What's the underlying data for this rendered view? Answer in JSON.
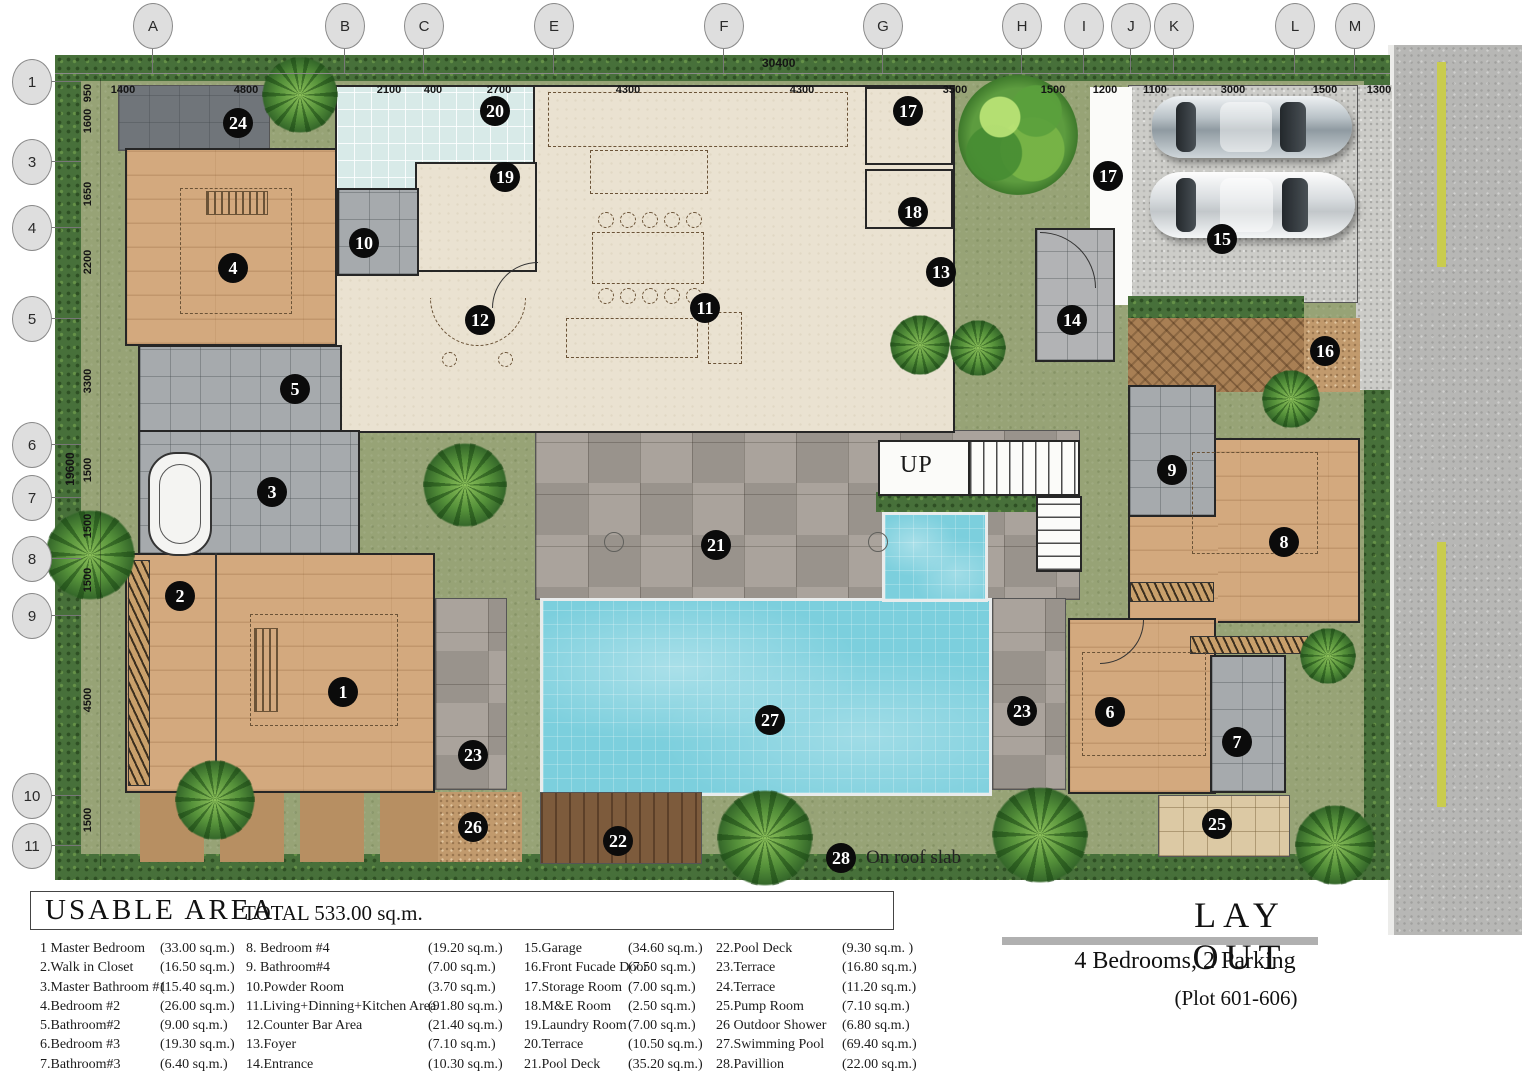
{
  "header": {
    "up_label": "UP",
    "roof_label": "On roof slab",
    "overall_width": "30400",
    "overall_height": "19600"
  },
  "legend": {
    "title": "USABLE  AREA",
    "total": "TOTAL 533.00 sq.m.",
    "columns": [
      {
        "left": 40,
        "area_left": 120,
        "items": [
          [
            "1 Master Bedroom",
            "(33.00 sq.m.)"
          ],
          [
            "2.Walk in Closet",
            "(16.50 sq.m.)"
          ],
          [
            "3.Master Bathroom #1",
            "(15.40 sq.m.)"
          ],
          [
            "4.Bedroom #2",
            "(26.00 sq.m.)"
          ],
          [
            "5.Bathroom#2",
            "(9.00  sq.m.)"
          ],
          [
            "6.Bedroom #3",
            "(19.30 sq.m.)"
          ],
          [
            "7.Bathroom#3",
            "(6.40  sq.m.)"
          ]
        ]
      },
      {
        "left": 246,
        "area_left": 182,
        "items": [
          [
            "8. Bedroom #4",
            "(19.20 sq.m.)"
          ],
          [
            "9. Bathroom#4",
            "(7.00  sq.m.)"
          ],
          [
            "10.Powder  Room",
            "(3.70  sq.m.)"
          ],
          [
            "11.Living+Dinning+Kitchen Area",
            "(91.80 sq.m.)"
          ],
          [
            "12.Counter Bar Area",
            "(21.40 sq.m.)"
          ],
          [
            "13.Foyer",
            "(7.10  sq.m.)"
          ],
          [
            "14.Entrance",
            "(10.30 sq.m.)"
          ]
        ]
      },
      {
        "left": 524,
        "area_left": 104,
        "items": [
          [
            "15.Garage",
            "(34.60 sq.m.)"
          ],
          [
            "16.Front Fucade Door",
            "(7.50 sq.m.)"
          ],
          [
            "17.Storage  Room",
            "(7.00  sq.m.)"
          ],
          [
            "18.M&E Room",
            "(2.50  sq.m.)"
          ],
          [
            "19.Laundry Room",
            "(7.00  sq.m.)"
          ],
          [
            "20.Terrace",
            "(10.50 sq.m.)"
          ],
          [
            "21.Pool  Deck",
            "(35.20 sq.m.)"
          ]
        ]
      },
      {
        "left": 716,
        "area_left": 126,
        "items": [
          [
            "22.Pool Deck",
            "(9.30 sq.m. )"
          ],
          [
            "23.Terrace",
            "(16.80 sq.m.)"
          ],
          [
            "24.Terrace",
            "(11.20 sq.m.)"
          ],
          [
            "25.Pump Room",
            "(7.10  sq.m.)"
          ],
          [
            "26 Outdoor Shower",
            "(6.80  sq.m.)"
          ],
          [
            "27.Swimming Pool",
            "(69.40 sq.m.)"
          ],
          [
            "28.Pavillion",
            "(22.00 sq.m.)"
          ]
        ]
      }
    ]
  },
  "layout_panel": {
    "title": "LAY OUT",
    "subtitle": "4 Bedrooms, 2 Parking",
    "plot": "(Plot  601-606)"
  },
  "grid": {
    "top": [
      {
        "label": "A",
        "x": 152
      },
      {
        "label": "B",
        "x": 344
      },
      {
        "label": "C",
        "x": 423
      },
      {
        "label": "E",
        "x": 553
      },
      {
        "label": "F",
        "x": 723
      },
      {
        "label": "G",
        "x": 882
      },
      {
        "label": "H",
        "x": 1021
      },
      {
        "label": "I",
        "x": 1083
      },
      {
        "label": "J",
        "x": 1130
      },
      {
        "label": "K",
        "x": 1173
      },
      {
        "label": "L",
        "x": 1294
      },
      {
        "label": "M",
        "x": 1354
      }
    ],
    "left": [
      {
        "label": "1",
        "y": 81
      },
      {
        "label": "3",
        "y": 161
      },
      {
        "label": "4",
        "y": 227
      },
      {
        "label": "5",
        "y": 318
      },
      {
        "label": "6",
        "y": 444
      },
      {
        "label": "7",
        "y": 497
      },
      {
        "label": "8",
        "y": 558
      },
      {
        "label": "9",
        "y": 615
      },
      {
        "label": "10",
        "y": 795
      },
      {
        "label": "11",
        "y": 845
      }
    ]
  },
  "dims": {
    "top": [
      {
        "t": "1400",
        "x": 123
      },
      {
        "t": "4800",
        "x": 246
      },
      {
        "t": "2100",
        "x": 389
      },
      {
        "t": "400",
        "x": 433
      },
      {
        "t": "2700",
        "x": 499
      },
      {
        "t": "4300",
        "x": 628
      },
      {
        "t": "4300",
        "x": 802
      },
      {
        "t": "3500",
        "x": 955
      },
      {
        "t": "1500",
        "x": 1053
      },
      {
        "t": "1200",
        "x": 1105
      },
      {
        "t": "1100",
        "x": 1155
      },
      {
        "t": "3000",
        "x": 1233
      },
      {
        "t": "1500",
        "x": 1325
      },
      {
        "t": "1300",
        "x": 1379
      }
    ],
    "left": [
      {
        "t": "950",
        "y": 93
      },
      {
        "t": "1600",
        "y": 121
      },
      {
        "t": "1650",
        "y": 194
      },
      {
        "t": "2200",
        "y": 262
      },
      {
        "t": "3300",
        "y": 381
      },
      {
        "t": "1500",
        "y": 470
      },
      {
        "t": "1500",
        "y": 526
      },
      {
        "t": "1500",
        "y": 580
      },
      {
        "t": "4500",
        "y": 700
      },
      {
        "t": "1500",
        "y": 820
      }
    ]
  },
  "markers": [
    {
      "n": "1",
      "x": 343,
      "y": 692
    },
    {
      "n": "2",
      "x": 180,
      "y": 596
    },
    {
      "n": "3",
      "x": 272,
      "y": 492
    },
    {
      "n": "4",
      "x": 233,
      "y": 268
    },
    {
      "n": "5",
      "x": 295,
      "y": 389
    },
    {
      "n": "6",
      "x": 1110,
      "y": 712
    },
    {
      "n": "7",
      "x": 1237,
      "y": 742
    },
    {
      "n": "8",
      "x": 1284,
      "y": 542
    },
    {
      "n": "9",
      "x": 1172,
      "y": 470
    },
    {
      "n": "10",
      "x": 364,
      "y": 243
    },
    {
      "n": "11",
      "x": 705,
      "y": 308
    },
    {
      "n": "12",
      "x": 480,
      "y": 320
    },
    {
      "n": "13",
      "x": 941,
      "y": 272
    },
    {
      "n": "14",
      "x": 1072,
      "y": 320
    },
    {
      "n": "15",
      "x": 1222,
      "y": 239
    },
    {
      "n": "16",
      "x": 1325,
      "y": 351
    },
    {
      "n": "17",
      "x": 908,
      "y": 111
    },
    {
      "n": "17",
      "x": 1108,
      "y": 176
    },
    {
      "n": "18",
      "x": 913,
      "y": 212
    },
    {
      "n": "19",
      "x": 505,
      "y": 177
    },
    {
      "n": "20",
      "x": 495,
      "y": 111
    },
    {
      "n": "21",
      "x": 716,
      "y": 545
    },
    {
      "n": "22",
      "x": 618,
      "y": 841
    },
    {
      "n": "23",
      "x": 473,
      "y": 755
    },
    {
      "n": "23",
      "x": 1022,
      "y": 711
    },
    {
      "n": "24",
      "x": 238,
      "y": 123
    },
    {
      "n": "25",
      "x": 1217,
      "y": 824
    },
    {
      "n": "26",
      "x": 473,
      "y": 827
    },
    {
      "n": "27",
      "x": 770,
      "y": 720
    },
    {
      "n": "28",
      "x": 841,
      "y": 858
    }
  ]
}
